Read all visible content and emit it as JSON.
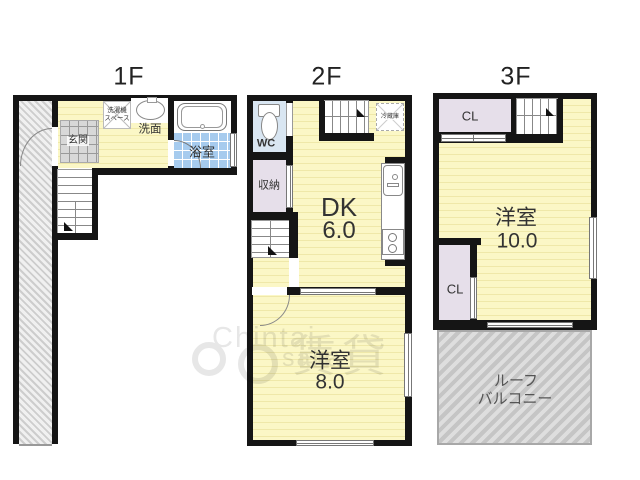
{
  "floors": {
    "f1": {
      "title": "1F",
      "labels": {
        "genkan": "玄関",
        "washer1": "洗濯機",
        "washer2": "スペース",
        "senmen": "洗面",
        "bath": "浴室"
      }
    },
    "f2": {
      "title": "2F",
      "labels": {
        "wc": "WC",
        "storage": "収納",
        "fridge": "冷蔵庫",
        "dk": "DK",
        "dk_size": "6.0",
        "room": "洋室",
        "room_size": "8.0"
      }
    },
    "f3": {
      "title": "3F",
      "labels": {
        "cl_top": "CL",
        "cl_bottom": "CL",
        "room": "洋室",
        "room_size": "10.0",
        "balcony1": "ルーフ",
        "balcony2": "バルコニー"
      }
    }
  },
  "watermark": {
    "word1": "Chintai",
    "word2": "saka",
    "kanji": "賃貸"
  },
  "colors": {
    "wall": "#151515",
    "yellow": "#fbf7c6",
    "yellowStripe": "#efe8a9",
    "bathBlue": "#a6cbee",
    "wcBlue": "#d9e6f2",
    "lavender": "#e6dfea",
    "tileGray": "#d8d8d8",
    "hatchGray": "#cdcdcd",
    "balconyGray": "#c5c5c5"
  }
}
